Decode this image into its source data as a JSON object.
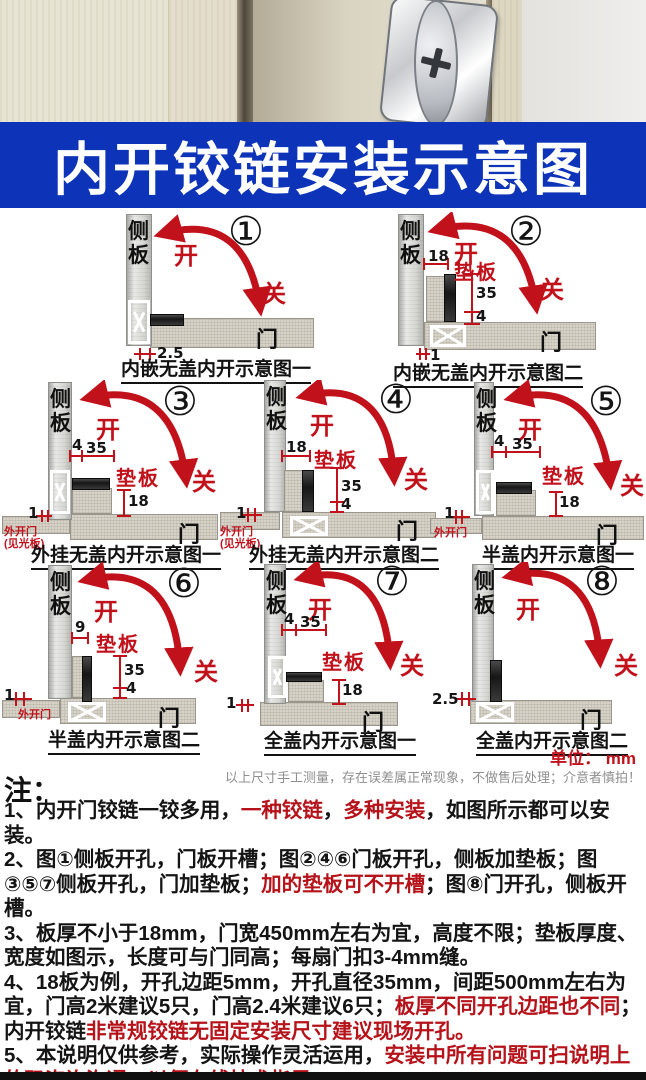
{
  "banner": {
    "title": "内开铰链安装示意图",
    "bg": "#0c33b8",
    "fg": "#ffffff"
  },
  "labels": {
    "side_panel": "侧板",
    "door": "门",
    "open": "开",
    "close": "关",
    "pad": "垫板"
  },
  "colors": {
    "accent_red": "#c1121c",
    "banner_blue": "#0c33b8"
  },
  "diagrams": [
    {
      "num": "①",
      "caption": "内嵌无盖内开示意图一",
      "dims": [
        "2.5"
      ],
      "pad_label": null,
      "corner_label": null
    },
    {
      "num": "②",
      "caption": "内嵌无盖内开示意图二",
      "dims": [
        "18",
        "35",
        "4",
        "1"
      ],
      "pad_label": "垫板",
      "corner_label": null
    },
    {
      "num": "③",
      "caption": "外挂无盖内开示意图一",
      "dims": [
        "4",
        "35",
        "18",
        "1"
      ],
      "pad_label": "垫板",
      "corner_label": "外开门\n(见光板)"
    },
    {
      "num": "④",
      "caption": "外挂无盖内开示意图二",
      "dims": [
        "18",
        "35",
        "4",
        "1"
      ],
      "pad_label": "垫板",
      "corner_label": "外开门\n(见光板)"
    },
    {
      "num": "⑤",
      "caption": "半盖内开示意图一",
      "dims": [
        "4",
        "35",
        "18",
        "1"
      ],
      "pad_label": "垫板",
      "corner_label": "外开门"
    },
    {
      "num": "⑥",
      "caption": "半盖内开示意图二",
      "dims": [
        "9",
        "35",
        "4",
        "1"
      ],
      "pad_label": "垫板",
      "corner_label": "外开门"
    },
    {
      "num": "⑦",
      "caption": "全盖内开示意图一",
      "dims": [
        "4",
        "35",
        "18",
        "1"
      ],
      "pad_label": "垫板",
      "corner_label": null
    },
    {
      "num": "⑧",
      "caption": "全盖内开示意图二",
      "dims": [
        "2.5"
      ],
      "pad_label": null,
      "corner_label": null
    }
  ],
  "unit_label": "单位： mm",
  "disclaimer": "以上尺寸手工测量，存在误差属正常现象，不做售后处理；介意者慎拍！",
  "notes_title": "注：",
  "notes": [
    [
      {
        "t": "1、内开门铰链一铰多用，"
      },
      {
        "t": "一种铰链",
        "red": true
      },
      {
        "t": "，"
      },
      {
        "t": "多种安装",
        "red": true
      },
      {
        "t": "，如图所示都可以安装。"
      }
    ],
    [
      {
        "t": "2、图①侧板开孔，门板开槽；图②④⑥门板开孔，侧板加垫板；图③⑤⑦侧板开孔，门加垫板；"
      },
      {
        "t": "加的垫板可不开槽",
        "red": true
      },
      {
        "t": "；图⑧门开孔，侧板开槽。"
      }
    ],
    [
      {
        "t": "3、板厚不小于18mm，门宽450mm左右为宜，高度不限；垫板厚度、宽度如图示，长度可与门同高；每扇门扣3-4mm缝。"
      }
    ],
    [
      {
        "t": "4、18板为例，开孔边距5mm，开孔直径35mm，间距500mm左右为宜，门高2米建议5只，门高2.4米建议6只；"
      },
      {
        "t": "板厚不同开孔边距也不同",
        "red": true
      },
      {
        "t": "；内开铰链"
      },
      {
        "t": "非常规铰链无固定安装尺寸建议现场开孔。",
        "red": true
      }
    ],
    [
      {
        "t": "5、本说明仅供参考，实际操作灵活运用，"
      },
      {
        "t": "安装中所有问题可扫说明上的码咨询沟通，以便在线技术指导。",
        "red": true
      }
    ]
  ]
}
